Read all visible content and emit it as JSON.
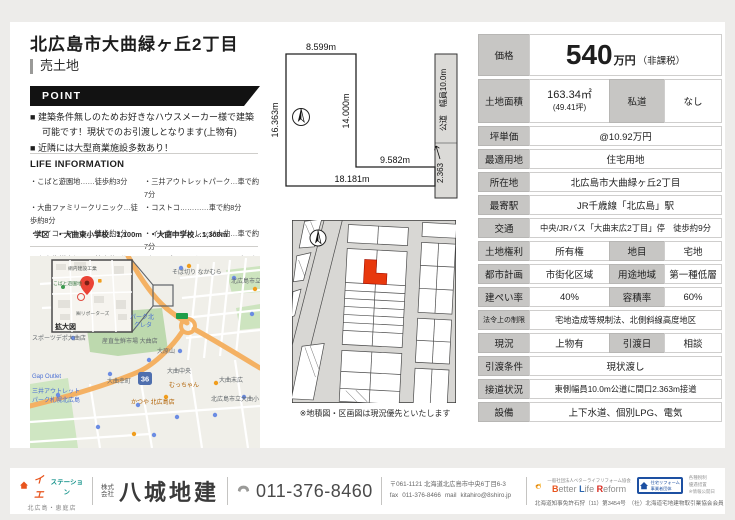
{
  "header": {
    "title": "北広島市大曲緑ヶ丘2丁目",
    "subtitle": "売土地"
  },
  "point": {
    "label": "POINT",
    "items": [
      "建築条件無しのためお好きなハウスメーカー様で建築可能です！現状でのお引渡しとなります(上物有)",
      "近隣には大型商業施設多数あり！"
    ]
  },
  "life": {
    "heading": "LIFE INFORMATION",
    "rows": [
      {
        "l": "・こばと遊園地……徒歩約3分",
        "r": "・三井アウトレットパーク…車で約7分"
      },
      {
        "l": "・大曲ファミリークリニック…徒歩約8分",
        "r": "・コストコ…………車で約8分"
      },
      {
        "l": "・セイコーマート…徒歩約9分",
        "r": "・インターヴィレッジ大曲…車で約7分"
      },
      {
        "l": "・産直生鮮市場……徒歩約9分",
        "r": "（スーパーアークス、カインズetc）"
      }
    ],
    "school": "学区　・大曲東小学校…1,100m　・大曲中学校…1,300m"
  },
  "survey": {
    "top": "8.599m",
    "left": "16.363m",
    "right_inner": "14.000m",
    "strip_top": "9.582m",
    "bottom": "18.181m",
    "frontage": "2.363",
    "road": "公道　幅員10.0m"
  },
  "block": {
    "note": "※地積図・区画図は現況優先といたします"
  },
  "map": {
    "inset": {
      "labels": [
        "網内建設工業",
        "こばと遊園地",
        "㈱リポーターズ"
      ],
      "zoom_label": "拡大図"
    },
    "shield": "36",
    "labels": [
      "そば切り なかむら",
      "北広島市立",
      "パーク北",
      "クレタ",
      "産直生鮮市場 大曲店",
      "大原山",
      "大曲中央",
      "むっちゃん",
      "大曲末広",
      "大曲幸町",
      "スポーツデポ大曲店",
      "Gap Outlet",
      "三井アウトレット",
      "パーク札幌北広島",
      "かつや 北広島店",
      "北広島市立大曲小"
    ]
  },
  "table": {
    "price": {
      "label": "価格",
      "number": "540",
      "unit": "万円",
      "note": "（非課税）"
    },
    "rows": [
      {
        "label": "土地面積",
        "v1": "163.34㎡",
        "v1b": "(49.41坪)",
        "label2": "私道",
        "v2": "なし"
      },
      {
        "label": "坪単価",
        "v": "@10.92万円"
      },
      {
        "label": "最適用地",
        "v": "住宅用地"
      },
      {
        "label": "所在地",
        "v": "北広島市大曲緑ヶ丘2丁目"
      },
      {
        "label": "最寄駅",
        "v": "JR千歳線「北広島」駅"
      },
      {
        "label": "交通",
        "v": "中央/JRバス「大曲末広2丁目」停　徒歩約9分"
      },
      {
        "label": "土地権利",
        "v": "所有権",
        "label2": "地目",
        "v2": "宅地"
      },
      {
        "label": "都市計画",
        "v": "市街化区域",
        "label2": "用途地域",
        "v2": "第一種低層"
      },
      {
        "label": "建ぺい率",
        "v": "40%",
        "label2": "容積率",
        "v2": "60%"
      },
      {
        "label": "法令上の制限",
        "v": "宅地造成等規制法、北側斜線高度地区"
      },
      {
        "label": "現況",
        "v": "上物有",
        "label2": "引渡日",
        "v2": "相談"
      },
      {
        "label": "引渡条件",
        "v": "現状渡し"
      },
      {
        "label": "接道状況",
        "v": "東側幅員10.0m公道に間口2.363m接道"
      },
      {
        "label": "設備",
        "v": "上下水道、個別LPG、電気"
      }
    ]
  },
  "footer": {
    "brand": {
      "name_a": "イエ",
      "name_b": "ステーション",
      "branch": "北広島・恵庭店"
    },
    "company": {
      "prefix_a": "株式",
      "prefix_b": "会社",
      "name": "八城地建"
    },
    "phone": "011-376-8460",
    "address": {
      "line1": "〒061-1121 北海道北広島市中央6丁目6-3",
      "fax_label": "fax",
      "fax": "011-376-8466",
      "mail_label": "mail",
      "mail": "kitahiro@8shiro.jp"
    },
    "blr": {
      "caption": "一般社団法人ベターライフリフォーム協会",
      "b": "B",
      "etter": "etter",
      "l": "L",
      "ife": "ife",
      "r": "R",
      "eform": "eform"
    },
    "reform_box": {
      "line1": "住宅リフォーム",
      "line2": "事業者団体"
    },
    "notes": [
      "各種税制",
      "優遇措置",
      "※情報公開日"
    ],
    "license": "北海道知事免許石狩（11）第3454号　（社）北海道宅地建物取引業協会会員"
  }
}
